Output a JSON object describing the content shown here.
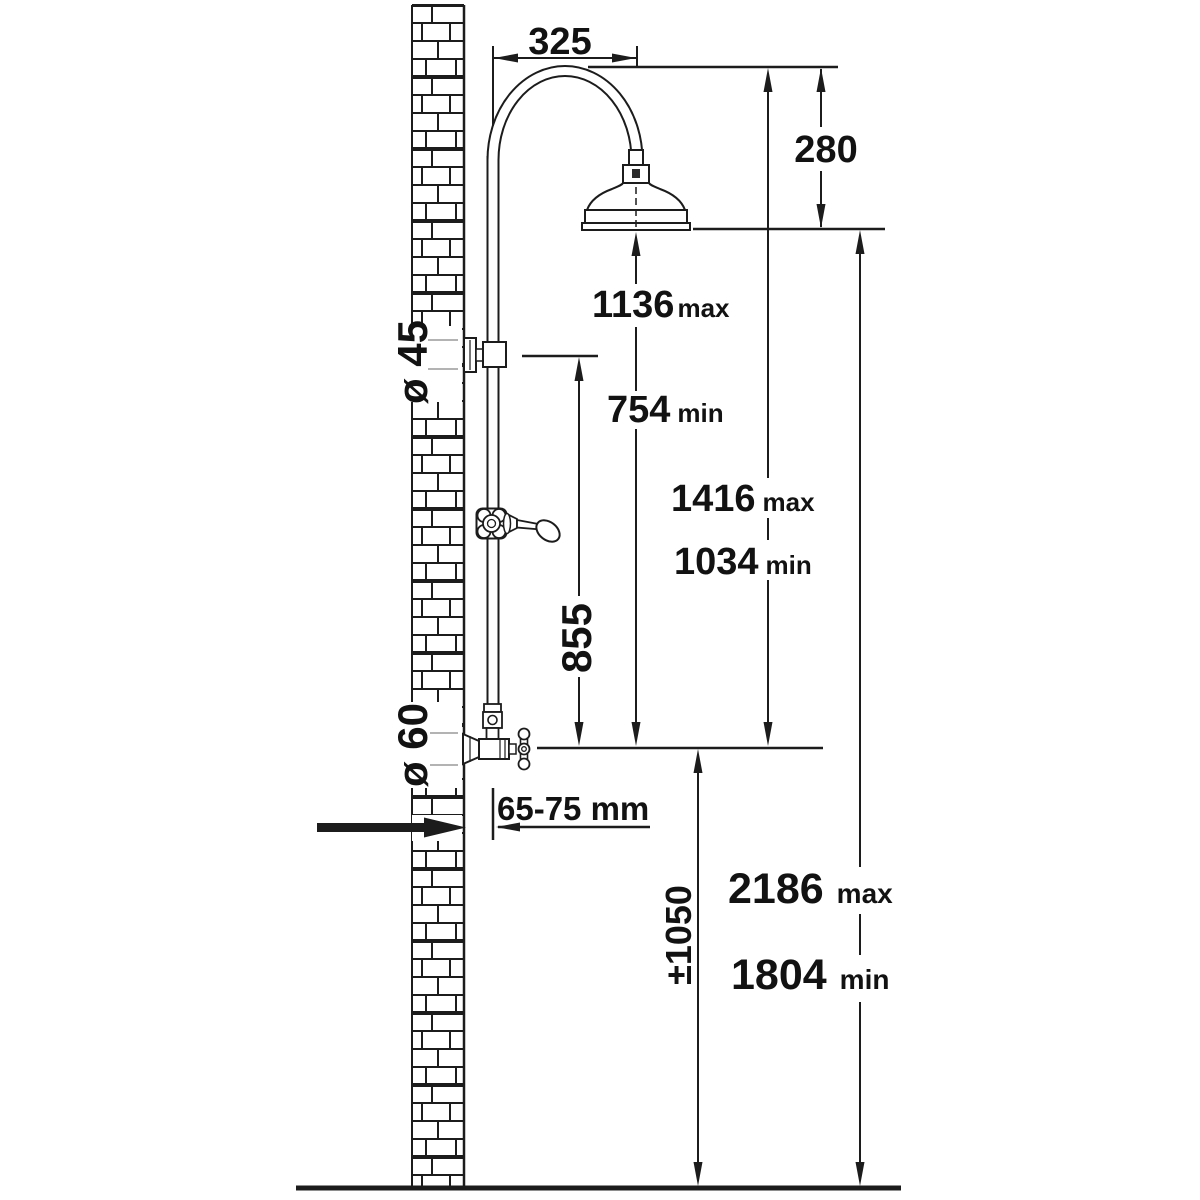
{
  "title": "Shower column installation dimensions diagram",
  "colors": {
    "background": "#ffffff",
    "line": "#1c1c1c",
    "text": "#111111"
  },
  "dimensions": {
    "arm_projection": {
      "value": "325"
    },
    "head_drop": {
      "value": "280"
    },
    "head_to_diverter": {
      "max_value": "1136",
      "max_label": "max",
      "min_value": "754",
      "min_label": "min"
    },
    "column_top_to_diverter": {
      "max_value": "1416",
      "max_label": "max",
      "min_value": "1034",
      "min_label": "min"
    },
    "bracket_to_diverter": {
      "value": "855"
    },
    "upper_bracket_diameter": {
      "value": "ø 45"
    },
    "diverter_diameter": {
      "value": "ø 60"
    },
    "wall_inlet_depth": {
      "value": "65-75 mm"
    },
    "inlet_height": {
      "value": "±1050"
    },
    "overall_height": {
      "max_value": "2186",
      "max_label": "max",
      "min_value": "1804",
      "min_label": "min"
    }
  }
}
